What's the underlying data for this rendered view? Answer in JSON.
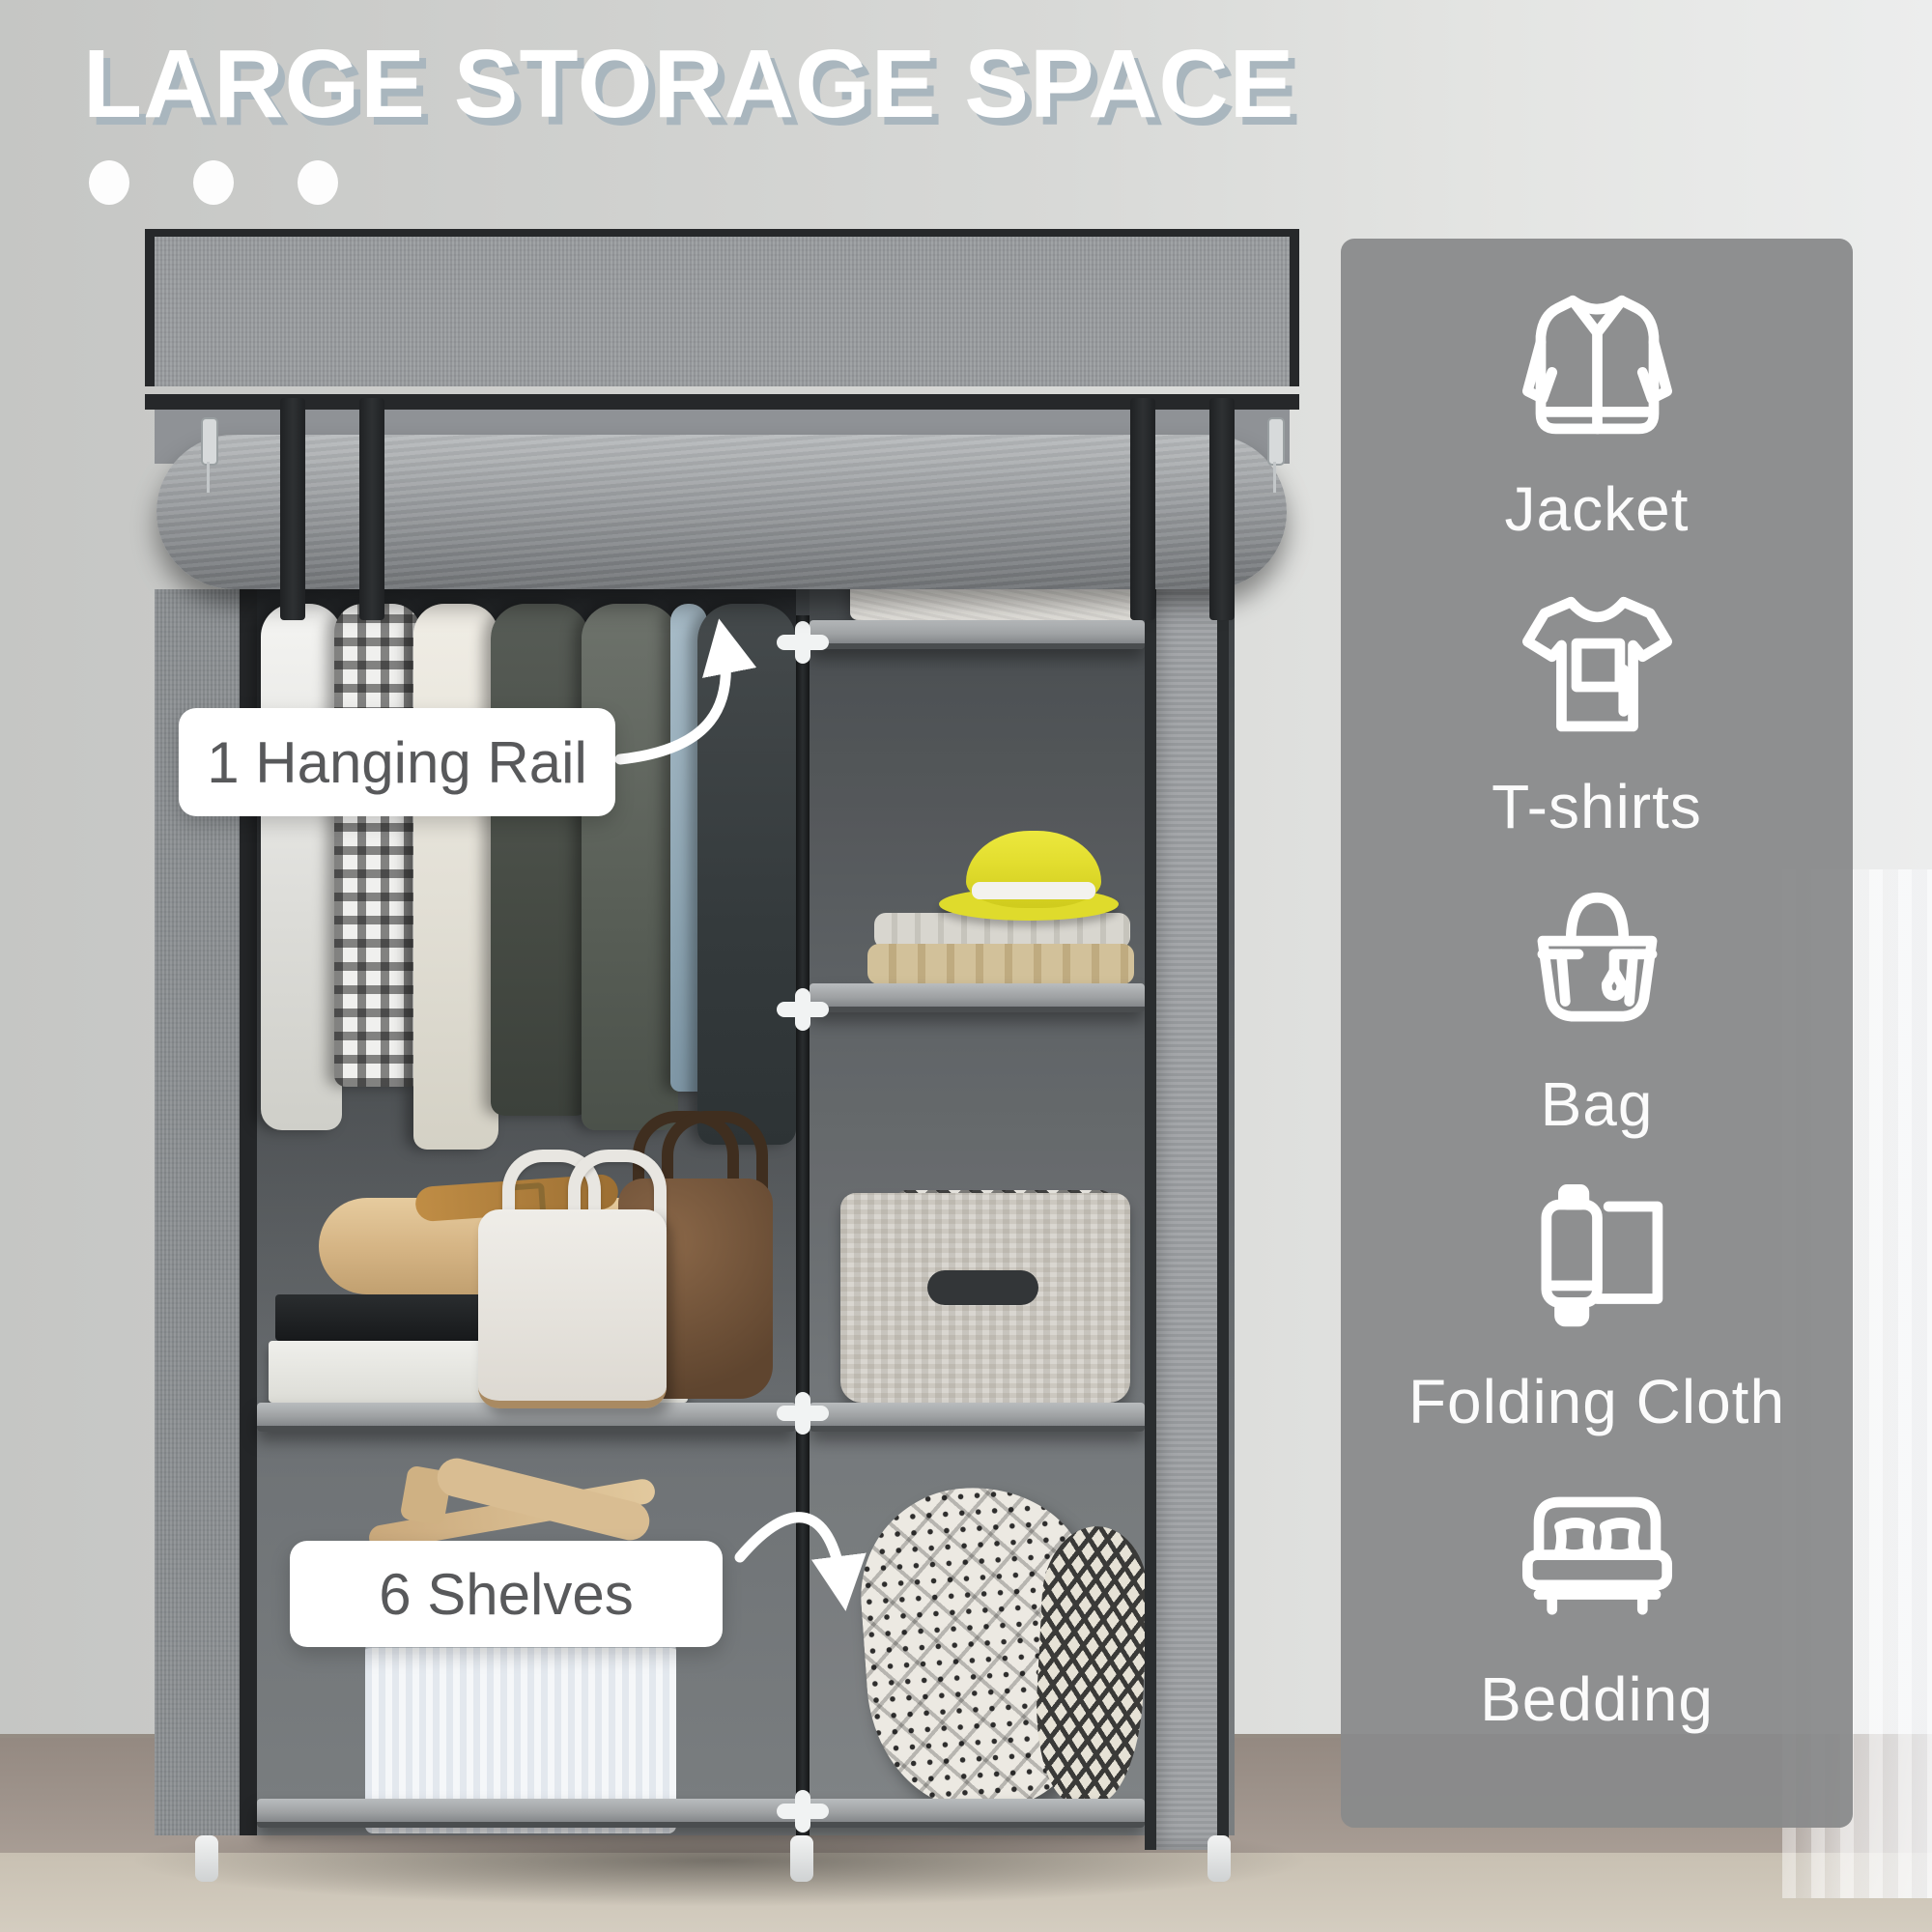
{
  "header": {
    "title": "LARGE STORAGE SPACE",
    "dots_count": 3
  },
  "callouts": {
    "hanging_rail": {
      "label": "1 Hanging Rail"
    },
    "shelves": {
      "label": "6 Shelves"
    }
  },
  "sidebar": {
    "items": [
      {
        "icon": "jacket-icon",
        "label": "Jacket"
      },
      {
        "icon": "tshirt-icon",
        "label": "T-shirts"
      },
      {
        "icon": "bag-icon",
        "label": "Bag"
      },
      {
        "icon": "folding-cloth-icon",
        "label": "Folding Cloth"
      },
      {
        "icon": "bedding-icon",
        "label": "Bedding"
      }
    ]
  },
  "colors": {
    "title_text": "#ffffff",
    "title_shadow": "#a9b6be",
    "panel_bg": "#898a8b",
    "callout_bg": "#ffffff",
    "callout_text": "#58595b",
    "hat_yellow": "#e3de2f",
    "wall": "#d0d1cf",
    "floor": "#a1968e",
    "fabric_gray": "#9b9ea1",
    "frame_dark": "#2b2e30"
  }
}
